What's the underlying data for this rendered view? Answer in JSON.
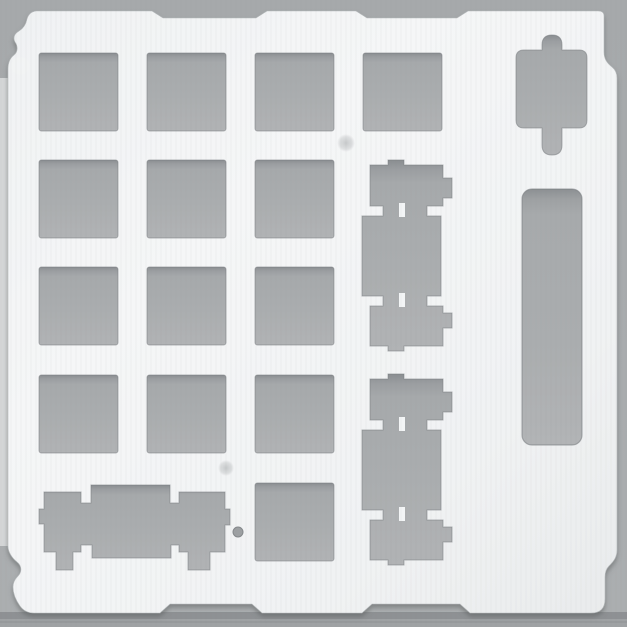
{
  "image": {
    "subject": "keyboard switch mounting plate",
    "description": "Top-down photo of a white numpad-style keyboard plate with laser-cut switch and stabilizer cutouts on a gray surface",
    "text_content": "none"
  },
  "colors": {
    "background": "#a8abad",
    "background_top": "#a6a9ab",
    "background_bottom": "#abaeb0",
    "plate_white": "#f3f5f6",
    "plate_corner_shade": "#e9ebec",
    "cutout_gray": "#aaadaf",
    "cutout_top_shadow": "#8a8e91",
    "cutout_edge": "#8b8f92",
    "surface_edge_shadow": "#8e9194",
    "surface_lower_strip": "#9fa2a4",
    "left_light_strip": "#dadcdd"
  },
  "plate": {
    "outline_path": "M36,11 H152 L163,18 H256 L267,11 H356 L367,18 H457 L468,11 H598 Q604,11 604,16 V52 C604,59 607,63 612,67 Q617,71 617,78 V550 C617,557 614,561 609,566 Q605,570 605,577 V599 Q605,613 591,613 H470 L460,604 H372 L362,613 H262 L252,604 H170 L160,613 H34 Q25,613 20,606 C15,599 13,592 13,587 C13,583 15,579 18,576 C22,572 22,566 17,562 C12,558 8,552 8,546 V69 C8,63 10,58 14,55 C18,52 18,46 15,42 C13,38 14,34 19,31 C24,28 26,24 27,19 Q29,12 36,11 Z",
    "switch_cutouts": {
      "count": 14,
      "width": 79,
      "height": 78,
      "corner_radius": 2.5,
      "positions": [
        [
          39,
          53
        ],
        [
          147,
          53
        ],
        [
          255,
          53
        ],
        [
          363,
          53
        ],
        [
          39,
          160
        ],
        [
          147,
          160
        ],
        [
          255,
          160
        ],
        [
          39,
          267
        ],
        [
          147,
          267
        ],
        [
          255,
          267
        ],
        [
          39,
          375
        ],
        [
          147,
          375
        ],
        [
          255,
          375
        ],
        [
          255,
          483
        ]
      ]
    },
    "stabilized_cutout_vertical": {
      "count": 2,
      "path": "M388,160 H404 V165 H443 V178 H452 V198 H443 V206 H427 V216 H441 V296 H427 V306 H443 V313 H452 V328 H443 V346 H404 V351 H388 V346 H370 V306 H383 V296 H362 V216 H383 V206 H370 V165 H388 Z",
      "y_offsets": [
        0,
        214
      ]
    },
    "wire_channel_notches": {
      "width": 6,
      "height": 14,
      "positions": [
        [
          399,
          203
        ],
        [
          399,
          293
        ],
        [
          399,
          417
        ],
        [
          399,
          507
        ]
      ]
    },
    "stabilized_cutout_horizontal": {
      "path": "M44,492 H81 V503 H91 V485 H170 V503 H179 V492 H225 V509 H230 V525 H225 V552 H210 V570 H188 V552 H179 V545 H171 V558 H92 V545 H81 V552 H73 V570 H56 V552 H44 V524 H39 V509 H44 Z"
    },
    "plus_key_cutout": {
      "path": "M524,50 H542 V45 Q542,35 552,35 Q562,35 562,45 V50 H579 Q587,50 587,58 V120 Q587,128 579,128 H562 V145 Q562,155 552,155 Q542,155 542,145 V128 H524 Q516,128 516,120 V58 Q516,50 524,50 Z"
    },
    "side_slot_cutout": {
      "x": 522,
      "y": 189,
      "width": 60,
      "height": 256,
      "corner_radius": 10
    },
    "screw_hole": {
      "cx": 238,
      "cy": 532,
      "r": 5
    },
    "smudges": [
      {
        "cx": 346,
        "cy": 143,
        "r": 9
      },
      {
        "cx": 226,
        "cy": 468,
        "r": 8
      }
    ],
    "edge_highlight_blob": {
      "cx": 20,
      "cy": 66,
      "rx": 11,
      "ry": 10
    }
  }
}
